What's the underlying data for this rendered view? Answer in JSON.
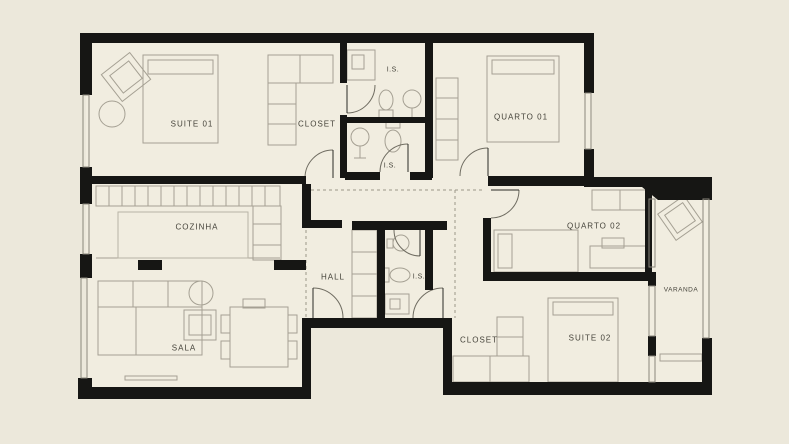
{
  "plan": {
    "type": "apartment-floor-plan",
    "rooms": {
      "suite01": {
        "label": "SUITE  01"
      },
      "closet1": {
        "label": "CLOSET"
      },
      "is1": {
        "label": "I.S."
      },
      "is2": {
        "label": "I.S."
      },
      "is3": {
        "label": "I.S."
      },
      "quarto01": {
        "label": "QUARTO 01"
      },
      "cozinha": {
        "label": "COZINHA"
      },
      "hall": {
        "label": "HALL"
      },
      "quarto02": {
        "label": "QUARTO  02"
      },
      "varanda": {
        "label": "VARANDA"
      },
      "sala": {
        "label": "SALA"
      },
      "closet2": {
        "label": "CLOSET"
      },
      "suite02": {
        "label": "SUITE  02"
      }
    },
    "colors": {
      "background": "#ece8db",
      "floor": "#f1ede0",
      "wall": "#161614",
      "furniture_line": "#a5a093",
      "text": "#45433a"
    }
  }
}
